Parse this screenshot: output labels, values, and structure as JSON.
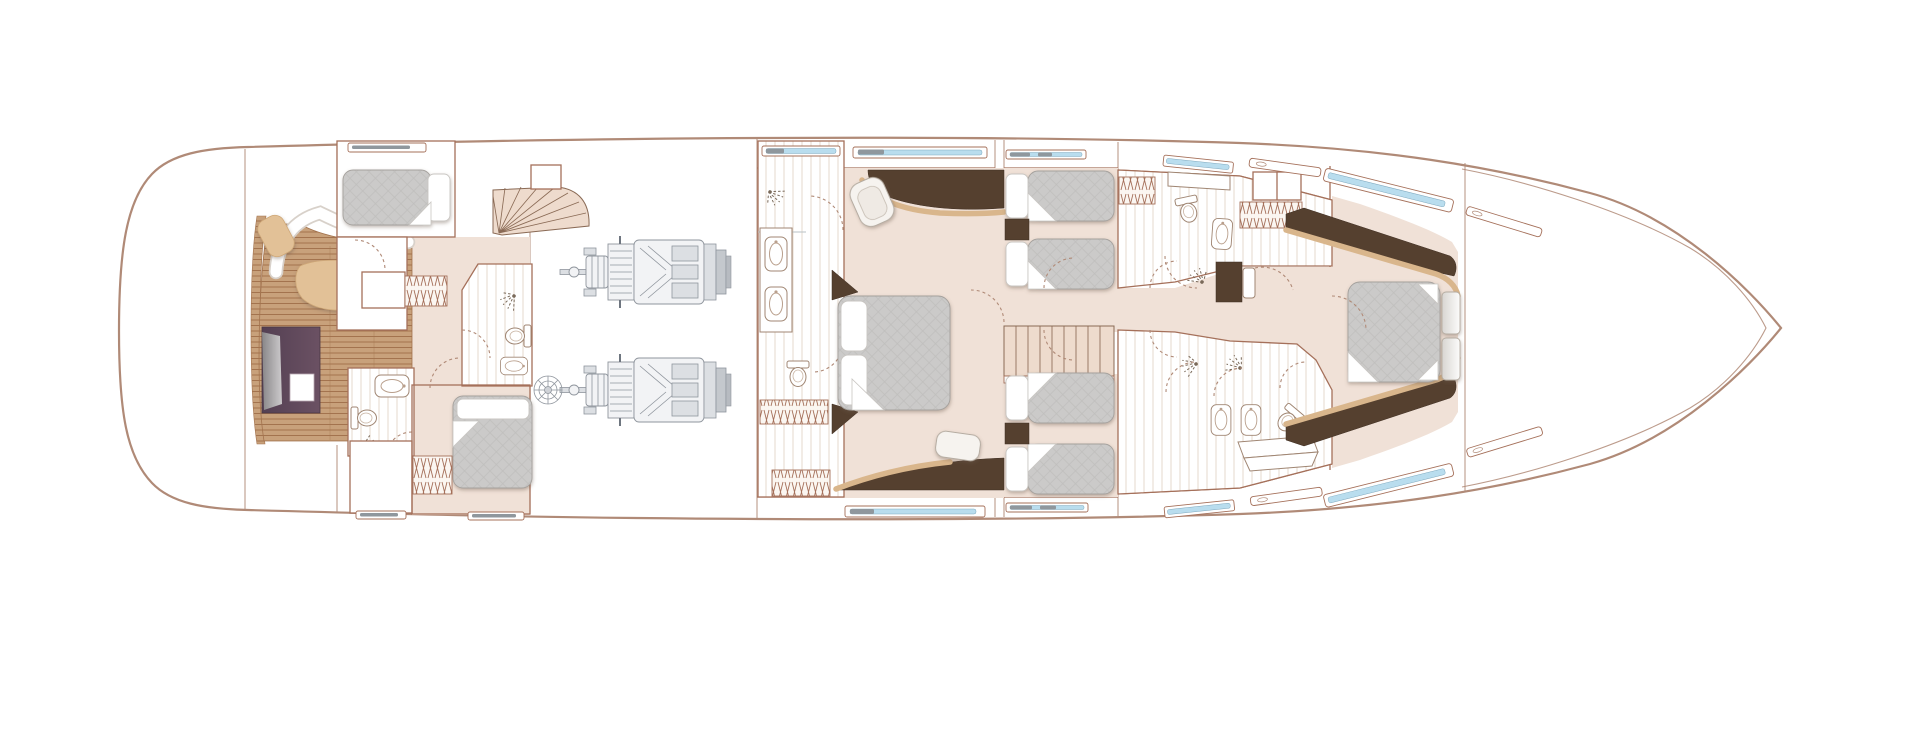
{
  "canvas": {
    "width": 1920,
    "height": 732,
    "background": "#ffffff"
  },
  "colors": {
    "hull": "#b08a77",
    "wall": "#a5705a",
    "floor": "#f0e1d7",
    "teak": "#c8a17b",
    "teakline": "#a3734e",
    "stair": "#eedbcd",
    "bed": "#cbcac9",
    "bedline": "#bdbcbb",
    "dark": "#55402f",
    "cushion": "#e2c197",
    "trim": "#d9b68c",
    "purple_a": "#6b5163",
    "purple_b": "#544053",
    "window": "#b9ddee",
    "windowg": "#8f979d",
    "engine": "#8f959d",
    "bg": "#ffffff"
  },
  "icons": {
    "shower": "shower-spray-icon",
    "toilet": "toilet-icon",
    "sink": "sink-basin-icon",
    "door_swing": "door-swing-arc-icon",
    "wardrobe": "hanging-locker-hatch-icon",
    "fan_stairs": "fan-staircase-icon",
    "straight_stairs": "straight-staircase-icon",
    "engine": "engine-icon",
    "double_bed": "double-bed-icon",
    "single_bed": "single-bed-icon",
    "sofa": "curved-sofa-icon",
    "hull_window": "hull-window-icon"
  }
}
